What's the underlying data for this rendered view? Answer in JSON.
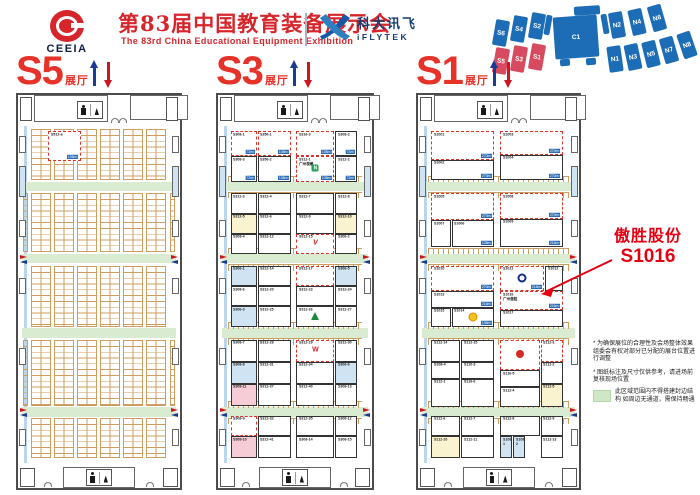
{
  "header": {
    "org_abbr": "CEEIA",
    "title_cn": "第83届中国教育装备展示会",
    "title_en": "The 83rd China Educational Equipment Exhibition",
    "sponsor_cn": "科大讯飞",
    "sponsor_en": "iFLYTEK"
  },
  "colors": {
    "brand_red": "#d6252b",
    "hall_label_red": "#e63229",
    "annotation_red": "#e60012",
    "minimap_blue": "#1d6db6",
    "minimap_red": "#d84a5f",
    "aisle_green": "#d9ecd2",
    "grid_orange": "#cf9d5f",
    "area_tag_blue": "#2b6cb5"
  },
  "minimap": {
    "blue": "#1d6db6",
    "red": "#d84a5f",
    "blocks": [
      {
        "label": "S6",
        "x": 4,
        "y": 16,
        "rot": 10
      },
      {
        "label": "S4",
        "x": 22,
        "y": 12,
        "rot": 10
      },
      {
        "label": "S2",
        "x": 40,
        "y": 9,
        "rot": 10
      },
      {
        "label": "",
        "x": 55,
        "y": 11,
        "w": 6,
        "h": 20,
        "rot": 10
      },
      {
        "label": "",
        "x": 84,
        "y": 2,
        "w": 26,
        "h": 9,
        "rot": -4
      },
      {
        "label": "C1",
        "x": 64,
        "y": 12,
        "w": 44,
        "h": 42,
        "rot": -4
      },
      {
        "label": "",
        "x": 70,
        "y": 55,
        "w": 10,
        "h": 7,
        "rot": -4
      },
      {
        "label": "",
        "x": 96,
        "y": 54,
        "w": 10,
        "h": 7,
        "rot": -4
      },
      {
        "label": "",
        "x": 112,
        "y": 10,
        "w": 6,
        "h": 20,
        "rot": -10
      },
      {
        "label": "N2",
        "x": 120,
        "y": 8,
        "rot": -10
      },
      {
        "label": "N4",
        "x": 140,
        "y": 5,
        "rot": -13
      },
      {
        "label": "N6",
        "x": 160,
        "y": 1,
        "rot": -16
      },
      {
        "label": "S5",
        "x": 4,
        "y": 44,
        "rot": 10,
        "c": "r"
      },
      {
        "label": "S3",
        "x": 22,
        "y": 42,
        "rot": 10,
        "c": "r"
      },
      {
        "label": "S1",
        "x": 40,
        "y": 40,
        "rot": 10,
        "c": "r"
      },
      {
        "label": "N1",
        "x": 118,
        "y": 42,
        "rot": -8
      },
      {
        "label": "N3",
        "x": 136,
        "y": 40,
        "rot": -12
      },
      {
        "label": "N5",
        "x": 154,
        "y": 37,
        "rot": -14
      },
      {
        "label": "N7",
        "x": 172,
        "y": 33,
        "rot": -16
      },
      {
        "label": "N8",
        "x": 190,
        "y": 28,
        "rot": -19
      }
    ]
  },
  "annotation": {
    "company": "傲胜股份",
    "booth": "S1016"
  },
  "notes": {
    "n1": "* 为确保展位的合理性及会场整体效果 组委会有权对部分已分配的展台位置进行调整",
    "n2": "* 图纸标注及尺寸仅供参考，请进场前复核现场位置"
  },
  "legend": {
    "text": "此区域范围内不得搭建封边结构 如周边无通道，需保持畅通"
  },
  "layout": {
    "aisles": [
      16.5,
      38,
      60,
      83.5
    ],
    "side_rooms": [
      {
        "y": 3,
        "h": 5
      },
      {
        "y": 12,
        "h": 9,
        "b": 1
      },
      {
        "y": 28,
        "h": 5
      },
      {
        "y": 45,
        "h": 5
      },
      {
        "y": 66,
        "h": 5
      },
      {
        "y": 90,
        "h": 5
      }
    ]
  },
  "logos": {
    "seewo": {
      "ch": "N"
    },
    "ring": {},
    "sun": {},
    "v": {
      "ch": "V"
    },
    "tree": {},
    "w": {
      "ch": "W"
    },
    "red": {}
  },
  "halls": [
    {
      "id": "S5",
      "label": "S5",
      "sub": "展厅",
      "grid": {
        "sections": [
          {
            "y": 1,
            "h": 15
          },
          {
            "y": 20,
            "h": 17.5
          },
          {
            "y": 41.5,
            "h": 18
          },
          {
            "y": 63.5,
            "h": 19.5
          },
          {
            "y": 86.5,
            "h": 12
          }
        ]
      },
      "booths": [
        {
          "n": "S512-a",
          "a": "108m²",
          "x": 17,
          "y": 1.5,
          "w": 21,
          "h": 9,
          "r": 1
        }
      ]
    },
    {
      "id": "S3",
      "label": "S3",
      "sub": "展厅",
      "combs": 1,
      "booths": [
        {
          "n": "S308-1",
          "a": "72m²",
          "x": 6,
          "y": 1.5,
          "w": 18,
          "h": 7.5,
          "r": 1
        },
        {
          "n": "S356-1",
          "a": "108m²",
          "x": 24.5,
          "y": 1.5,
          "w": 23,
          "h": 7.5,
          "r": 1
        },
        {
          "n": "S316-3",
          "a": "108m²",
          "x": 51,
          "y": 1.5,
          "w": 26,
          "h": 7.5,
          "r": 1
        },
        {
          "n": "S308-2",
          "a": "72m²",
          "x": 77.5,
          "y": 1.5,
          "w": 15,
          "h": 7.5
        },
        {
          "n": "S308-3",
          "a": "72m²",
          "x": 6,
          "y": 9,
          "w": 18,
          "h": 7.5
        },
        {
          "n": "S356-2",
          "a": "108m²",
          "x": 24.5,
          "y": 9,
          "w": 23,
          "h": 7.5
        },
        {
          "n": "S312-1",
          "nm": "广州视睿",
          "a": "108m²",
          "x": 51,
          "y": 9,
          "w": 26,
          "h": 7.5,
          "lg": "seewo",
          "r": 1
        },
        {
          "n": "S312-2",
          "a": "72m²",
          "x": 77.5,
          "y": 9,
          "w": 15,
          "h": 7.5
        },
        {
          "n": "S312-3",
          "x": 6,
          "y": 20,
          "w": 18,
          "h": 6
        },
        {
          "n": "S312-4",
          "x": 24.5,
          "y": 20,
          "w": 23,
          "h": 6
        },
        {
          "n": "S312-7",
          "x": 51,
          "y": 20,
          "w": 26,
          "h": 6
        },
        {
          "n": "S312-8",
          "x": 77.5,
          "y": 20,
          "w": 15,
          "h": 6
        },
        {
          "n": "S312-5",
          "x": 6,
          "y": 26,
          "w": 18,
          "h": 6,
          "f": "yellow"
        },
        {
          "n": "S312-6",
          "x": 24.5,
          "y": 26,
          "w": 23,
          "h": 6
        },
        {
          "n": "S312-9",
          "x": 51,
          "y": 26,
          "w": 26,
          "h": 6
        },
        {
          "n": "S312-10",
          "x": 77.5,
          "y": 26,
          "w": 15,
          "h": 6,
          "f": "yellow"
        },
        {
          "n": "S308-4",
          "x": 6,
          "y": 32,
          "w": 18,
          "h": 6
        },
        {
          "n": "S312-12",
          "x": 24.5,
          "y": 32,
          "w": 23,
          "h": 6
        },
        {
          "n": "S312-15",
          "x": 51,
          "y": 32,
          "w": 26,
          "h": 6,
          "lg": "v",
          "r": 1
        },
        {
          "n": "S306-2",
          "x": 77.5,
          "y": 32,
          "w": 15,
          "h": 6
        },
        {
          "n": "S306-1",
          "x": 6,
          "y": 41.5,
          "w": 18,
          "h": 6,
          "f": "blue"
        },
        {
          "n": "S312-14",
          "x": 24.5,
          "y": 41.5,
          "w": 23,
          "h": 6
        },
        {
          "n": "S312-17",
          "x": 51,
          "y": 41.5,
          "w": 26,
          "h": 6,
          "r": 1
        },
        {
          "n": "S306-5",
          "x": 77.5,
          "y": 41.5,
          "w": 15,
          "h": 6,
          "f": "blue"
        },
        {
          "n": "S308-6",
          "x": 6,
          "y": 47.5,
          "w": 18,
          "h": 6
        },
        {
          "n": "S312-20",
          "x": 24.5,
          "y": 47.5,
          "w": 23,
          "h": 6
        },
        {
          "n": "S312-23",
          "x": 51,
          "y": 47.5,
          "w": 26,
          "h": 6
        },
        {
          "n": "S312-24",
          "x": 77.5,
          "y": 47.5,
          "w": 15,
          "h": 6
        },
        {
          "n": "S306-3",
          "x": 6,
          "y": 53.5,
          "w": 18,
          "h": 6,
          "f": "blue"
        },
        {
          "n": "S312-25",
          "x": 24.5,
          "y": 53.5,
          "w": 23,
          "h": 6
        },
        {
          "n": "S312-26",
          "x": 51,
          "y": 53.5,
          "w": 26,
          "h": 6,
          "lg": "tree"
        },
        {
          "n": "S312-27",
          "x": 77.5,
          "y": 53.5,
          "w": 15,
          "h": 6
        },
        {
          "n": "S308-7",
          "x": 6,
          "y": 63.5,
          "w": 18,
          "h": 6.5
        },
        {
          "n": "S312-28",
          "x": 24.5,
          "y": 63.5,
          "w": 23,
          "h": 6.5
        },
        {
          "n": "S312-29",
          "x": 51,
          "y": 63.5,
          "w": 26,
          "h": 6.5,
          "lg": "w",
          "r": 1
        },
        {
          "n": "S312-30",
          "x": 77.5,
          "y": 63.5,
          "w": 15,
          "h": 6.5
        },
        {
          "n": "S308-8",
          "x": 6,
          "y": 70,
          "w": 18,
          "h": 6.5,
          "f": "blue"
        },
        {
          "n": "S312-31",
          "x": 24.5,
          "y": 70,
          "w": 23,
          "h": 6.5
        },
        {
          "n": "S312-34",
          "x": 51,
          "y": 70,
          "w": 26,
          "h": 6.5
        },
        {
          "n": "S306-6",
          "x": 77.5,
          "y": 70,
          "w": 15,
          "h": 6.5,
          "f": "blue"
        },
        {
          "n": "S308-11",
          "x": 6,
          "y": 76.5,
          "w": 18,
          "h": 6.5,
          "f": "pink"
        },
        {
          "n": "S312-37",
          "x": 24.5,
          "y": 76.5,
          "w": 23,
          "h": 6.5
        },
        {
          "n": "S312-40",
          "x": 51,
          "y": 76.5,
          "w": 26,
          "h": 6.5
        },
        {
          "n": "S308-13",
          "x": 77.5,
          "y": 76.5,
          "w": 15,
          "h": 6.5
        },
        {
          "n": "S308-9",
          "x": 6,
          "y": 86,
          "w": 18,
          "h": 6,
          "r": 1
        },
        {
          "n": "S312-32",
          "x": 24.5,
          "y": 86,
          "w": 23,
          "h": 6
        },
        {
          "n": "S312-35",
          "x": 51,
          "y": 86,
          "w": 26,
          "h": 6
        },
        {
          "n": "S308-12",
          "x": 77.5,
          "y": 86,
          "w": 15,
          "h": 6
        },
        {
          "n": "S308-10",
          "x": 6,
          "y": 92,
          "w": 18,
          "h": 6.5,
          "f": "pink"
        },
        {
          "n": "S312-41",
          "x": 24.5,
          "y": 92,
          "w": 23,
          "h": 6.5
        },
        {
          "n": "S308-14",
          "x": 51,
          "y": 92,
          "w": 26,
          "h": 6.5
        },
        {
          "n": "S308-15",
          "x": 77.5,
          "y": 92,
          "w": 15,
          "h": 6.5
        }
      ]
    },
    {
      "id": "S1",
      "label": "S1",
      "sub": "展厅",
      "combs": 1,
      "booths": [
        {
          "n": "S1001",
          "a": "270m²",
          "x": 6,
          "y": 1.5,
          "w": 41,
          "h": 8.5,
          "r": 1
        },
        {
          "n": "S1002",
          "a": "270m²",
          "x": 6,
          "y": 10,
          "w": 41,
          "h": 6
        },
        {
          "n": "S1003",
          "a": "270m²",
          "x": 51,
          "y": 1.5,
          "w": 41,
          "h": 7,
          "r": 1
        },
        {
          "n": "S1004",
          "a": "270m²",
          "x": 51,
          "y": 8.5,
          "w": 41,
          "h": 7.5
        },
        {
          "n": "S1005",
          "a": "270m²",
          "x": 6,
          "y": 20,
          "w": 41,
          "h": 8,
          "r": 1
        },
        {
          "n": "S1007",
          "x": 6,
          "y": 28,
          "w": 13,
          "h": 8
        },
        {
          "n": "S1006",
          "a": "108m²",
          "x": 19.5,
          "y": 28,
          "w": 27.5,
          "h": 8
        },
        {
          "n": "S1008",
          "a": "270m²",
          "x": 51,
          "y": 20,
          "w": 41,
          "h": 7.5,
          "r": 1
        },
        {
          "n": "S1009",
          "a": "216m²",
          "x": 51,
          "y": 27.5,
          "w": 41,
          "h": 8.5
        },
        {
          "n": "S1010",
          "a": "270m²",
          "x": 6,
          "y": 41.5,
          "w": 41,
          "h": 7.5,
          "r": 1
        },
        {
          "n": "S1011",
          "a": "216m²",
          "x": 51,
          "y": 41.5,
          "w": 29,
          "h": 7.5,
          "lg": "ring",
          "r": 1
        },
        {
          "n": "S1012",
          "x": 80.5,
          "y": 41.5,
          "w": 11.5,
          "h": 7.5
        },
        {
          "n": "S1013",
          "a": "216m²",
          "x": 6,
          "y": 49,
          "w": 41,
          "h": 5
        },
        {
          "n": "S1016",
          "nm": "广州傲胜",
          "a": "216m²",
          "x": 51,
          "y": 49,
          "w": 41,
          "h": 5.5,
          "r": 1
        },
        {
          "n": "S1015",
          "x": 6,
          "y": 54,
          "w": 13,
          "h": 5.5
        },
        {
          "n": "S1014",
          "a": "108m²",
          "x": 19.5,
          "y": 54,
          "w": 27.5,
          "h": 5.5,
          "lg": "sun"
        },
        {
          "n": "S1017",
          "x": 51,
          "y": 54.5,
          "w": 41,
          "h": 5
        },
        {
          "n": "S112-14",
          "x": 6,
          "y": 63.5,
          "w": 19,
          "h": 6.5
        },
        {
          "n": "S112-15",
          "x": 25.5,
          "y": 63.5,
          "w": 21.5,
          "h": 6.5
        },
        {
          "n": "",
          "x": 51,
          "y": 63.5,
          "w": 26,
          "h": 9,
          "lg": "red",
          "r": 1
        },
        {
          "n": "S112-3",
          "x": 77.5,
          "y": 63.5,
          "w": 14.5,
          "h": 6.5,
          "r": 1
        },
        {
          "n": "S108-4",
          "x": 6,
          "y": 70,
          "w": 19,
          "h": 5
        },
        {
          "n": "S110-3",
          "x": 25.5,
          "y": 70,
          "w": 21.5,
          "h": 5
        },
        {
          "n": "S112-2",
          "x": 77.5,
          "y": 70,
          "w": 14.5,
          "h": 6.5
        },
        {
          "n": "S112-1",
          "x": 6,
          "y": 75,
          "w": 19,
          "h": 8.5
        },
        {
          "n": "S116-6",
          "x": 25.5,
          "y": 75,
          "w": 21.5,
          "h": 8.5
        },
        {
          "n": "S116-5",
          "x": 51,
          "y": 72.5,
          "w": 26,
          "h": 5
        },
        {
          "n": "S112-4",
          "x": 51,
          "y": 77.5,
          "w": 26,
          "h": 6
        },
        {
          "n": "S112-5",
          "x": 77.5,
          "y": 76.5,
          "w": 14.5,
          "h": 7,
          "f": "yellow"
        },
        {
          "n": "S112-6",
          "x": 6,
          "y": 86,
          "w": 19,
          "h": 6
        },
        {
          "n": "S112-7",
          "x": 25.5,
          "y": 86,
          "w": 21.5,
          "h": 6
        },
        {
          "n": "S112-8",
          "x": 51,
          "y": 86,
          "w": 26,
          "h": 6
        },
        {
          "n": "S112-9",
          "x": 77.5,
          "y": 86,
          "w": 14.5,
          "h": 6
        },
        {
          "n": "S112-10",
          "x": 6,
          "y": 92,
          "w": 19,
          "h": 6.5,
          "f": "yellow"
        },
        {
          "n": "S112-11",
          "x": 25.5,
          "y": 92,
          "w": 21.5,
          "h": 6.5
        },
        {
          "n": "S108-1",
          "x": 51,
          "y": 92,
          "w": 8,
          "h": 6.5,
          "f": "blue"
        },
        {
          "n": "S108-2",
          "x": 59.5,
          "y": 92,
          "w": 8,
          "h": 6.5,
          "f": "blue"
        },
        {
          "n": "S112-13",
          "x": 77.5,
          "y": 92,
          "w": 14.5,
          "h": 6.5
        }
      ]
    }
  ]
}
